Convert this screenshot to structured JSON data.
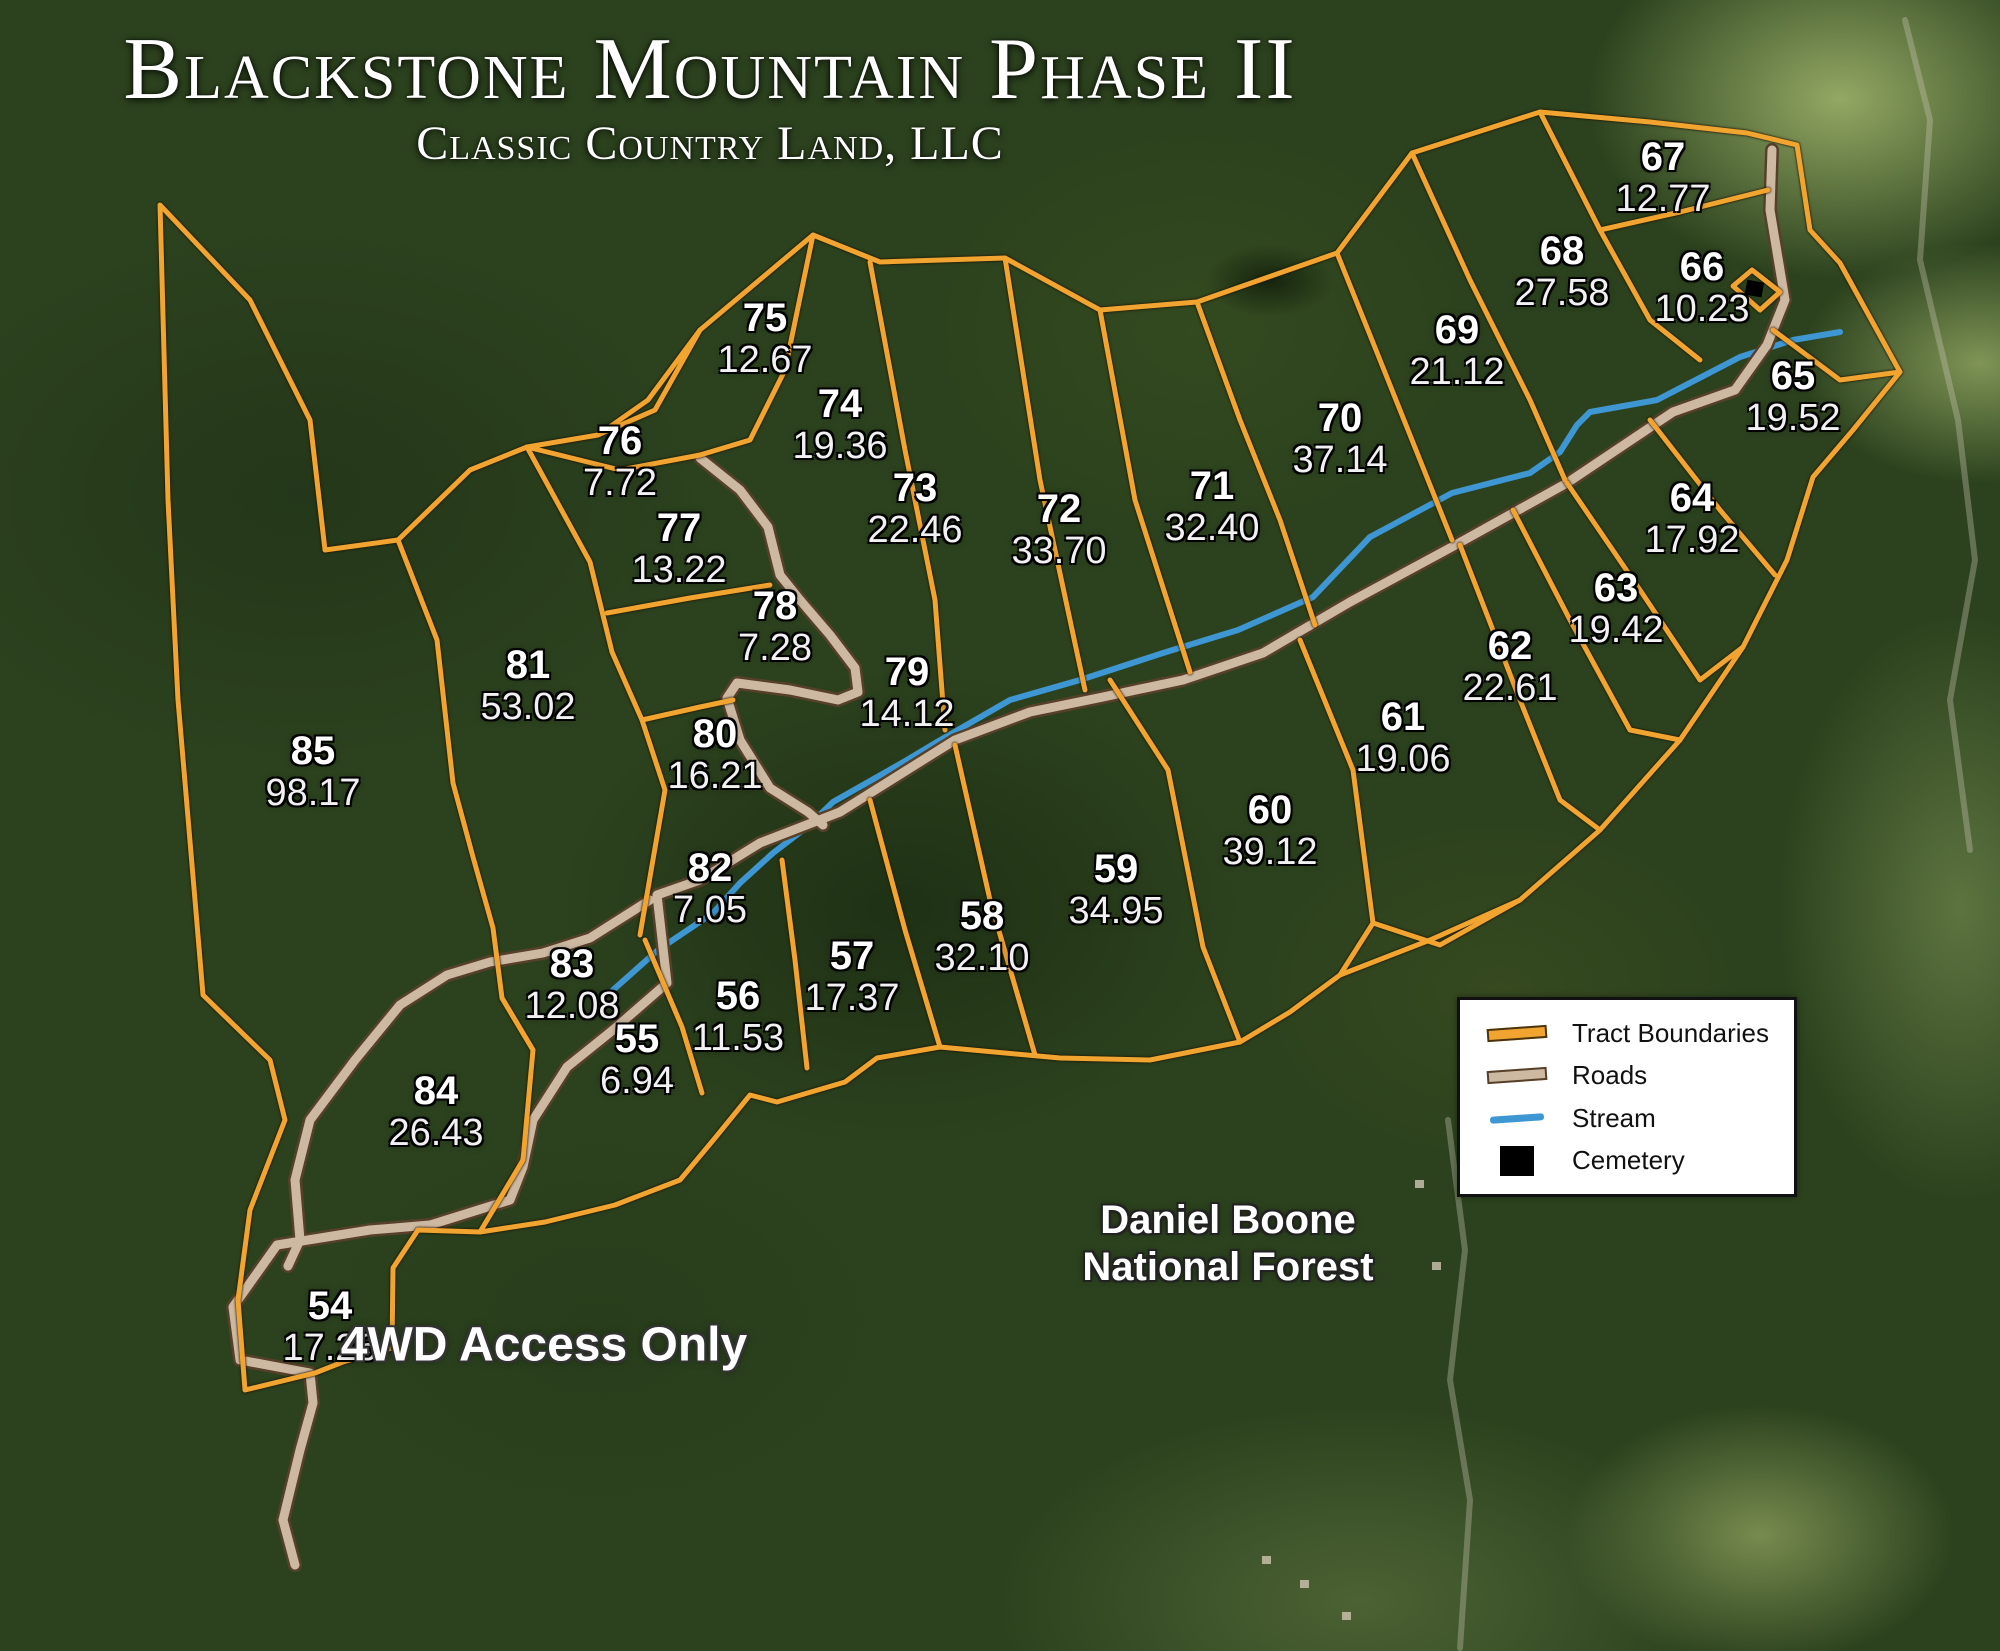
{
  "header": {
    "title": "Blackstone Mountain Phase II",
    "subtitle": "Classic Country Land, LLC"
  },
  "map": {
    "tracts": [
      {
        "id": "54",
        "acres": "17.26",
        "x": 330,
        "y": 1327
      },
      {
        "id": "55",
        "acres": "6.94",
        "x": 637,
        "y": 1060
      },
      {
        "id": "56",
        "acres": "11.53",
        "x": 738,
        "y": 1017
      },
      {
        "id": "57",
        "acres": "17.37",
        "x": 852,
        "y": 977
      },
      {
        "id": "58",
        "acres": "32.10",
        "x": 982,
        "y": 937
      },
      {
        "id": "59",
        "acres": "34.95",
        "x": 1116,
        "y": 890
      },
      {
        "id": "60",
        "acres": "39.12",
        "x": 1270,
        "y": 831
      },
      {
        "id": "61",
        "acres": "19.06",
        "x": 1403,
        "y": 738
      },
      {
        "id": "62",
        "acres": "22.61",
        "x": 1510,
        "y": 667
      },
      {
        "id": "63",
        "acres": "19.42",
        "x": 1616,
        "y": 609
      },
      {
        "id": "64",
        "acres": "17.92",
        "x": 1692,
        "y": 519
      },
      {
        "id": "65",
        "acres": "19.52",
        "x": 1793,
        "y": 397
      },
      {
        "id": "66",
        "acres": "10.23",
        "x": 1702,
        "y": 288
      },
      {
        "id": "67",
        "acres": "12.77",
        "x": 1663,
        "y": 178
      },
      {
        "id": "68",
        "acres": "27.58",
        "x": 1562,
        "y": 272
      },
      {
        "id": "69",
        "acres": "21.12",
        "x": 1457,
        "y": 351
      },
      {
        "id": "70",
        "acres": "37.14",
        "x": 1340,
        "y": 439
      },
      {
        "id": "71",
        "acres": "32.40",
        "x": 1212,
        "y": 507
      },
      {
        "id": "72",
        "acres": "33.70",
        "x": 1059,
        "y": 530
      },
      {
        "id": "73",
        "acres": "22.46",
        "x": 915,
        "y": 509
      },
      {
        "id": "74",
        "acres": "19.36",
        "x": 840,
        "y": 425
      },
      {
        "id": "75",
        "acres": "12.67",
        "x": 765,
        "y": 339
      },
      {
        "id": "76",
        "acres": "7.72",
        "x": 620,
        "y": 462
      },
      {
        "id": "77",
        "acres": "13.22",
        "x": 679,
        "y": 549
      },
      {
        "id": "78",
        "acres": "7.28",
        "x": 775,
        "y": 627
      },
      {
        "id": "79",
        "acres": "14.12",
        "x": 907,
        "y": 693
      },
      {
        "id": "80",
        "acres": "16.21",
        "x": 715,
        "y": 755
      },
      {
        "id": "81",
        "acres": "53.02",
        "x": 528,
        "y": 686
      },
      {
        "id": "82",
        "acres": "7.05",
        "x": 710,
        "y": 889
      },
      {
        "id": "83",
        "acres": "12.08",
        "x": 572,
        "y": 985
      },
      {
        "id": "84",
        "acres": "26.43",
        "x": 436,
        "y": 1112
      },
      {
        "id": "85",
        "acres": "98.17",
        "x": 313,
        "y": 772
      }
    ],
    "annotations": {
      "forest_line1": "Daniel Boone",
      "forest_line2": "National Forest",
      "access_note": "4WD Access Only"
    }
  },
  "legend": {
    "items": [
      {
        "label": "Tract Boundaries",
        "swatch": "boundary-line"
      },
      {
        "label": "Roads",
        "swatch": "road-line"
      },
      {
        "label": "Stream",
        "swatch": "stream-line"
      },
      {
        "label": "Cemetery",
        "swatch": "cemetery-square"
      }
    ]
  },
  "colors": {
    "boundary": "#F2A430",
    "road_fill": "#CDB9A2",
    "road_edge": "#57402A",
    "stream": "#3E97D3",
    "label_text": "#FFFFFF",
    "legend_bg": "#FFFFFF",
    "legend_border": "#111111",
    "legend_text": "#111111"
  }
}
